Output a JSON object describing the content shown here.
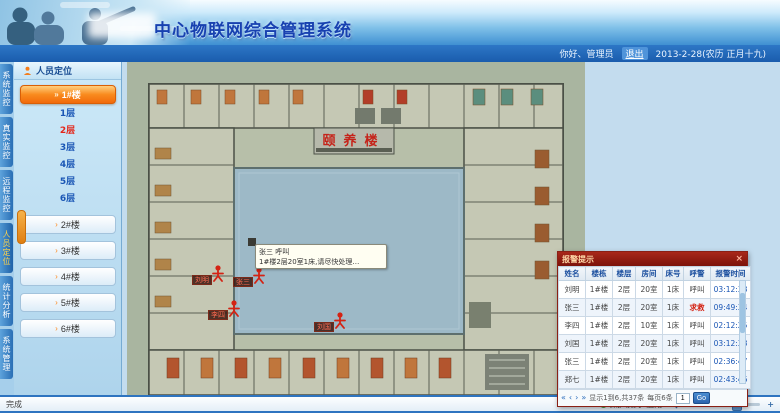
{
  "header": {
    "title": "中心物联网综合管理系统"
  },
  "userbar": {
    "greeting": "你好、管理员",
    "logout": "退出",
    "date": "2013-2-28(农历 正月十九)"
  },
  "nav_tabs": [
    {
      "label": "系统监控",
      "active": false
    },
    {
      "label": "真实监控",
      "active": false
    },
    {
      "label": "远程监控",
      "active": false
    },
    {
      "label": "人员定位",
      "active": true
    },
    {
      "label": "统计分析",
      "active": false
    },
    {
      "label": "系统管理",
      "active": false
    }
  ],
  "sidebar": {
    "header": "人员定位",
    "active_building": "1#楼",
    "floors": [
      {
        "label": "1层",
        "active": false
      },
      {
        "label": "2层",
        "active": true
      },
      {
        "label": "3层",
        "active": false
      },
      {
        "label": "4层",
        "active": false
      },
      {
        "label": "5层",
        "active": false
      },
      {
        "label": "6层",
        "active": false
      }
    ],
    "buildings": [
      "2#楼",
      "3#楼",
      "4#楼",
      "5#楼",
      "6#楼"
    ]
  },
  "plan": {
    "plaque": "颐养楼",
    "tooltip": {
      "line1": "张三 呼叫",
      "line2": "1#楼2层20室1床,请尽快处理…"
    },
    "markers": [
      {
        "name": "刘明"
      },
      {
        "name": "张三"
      },
      {
        "name": "李四"
      },
      {
        "name": "刘国"
      }
    ]
  },
  "popup": {
    "title": "报警提示",
    "close": "×",
    "columns": [
      "姓名",
      "楼栋",
      "楼层",
      "房间",
      "床号",
      "呼警",
      "报警时间"
    ],
    "rows": [
      [
        "刘明",
        "1#楼",
        "2层",
        "20室",
        "1床",
        "呼叫",
        "03:12:38"
      ],
      [
        "张三",
        "1#楼",
        "2层",
        "20室",
        "1床",
        "求救",
        "09:49:34"
      ],
      [
        "李四",
        "1#楼",
        "2层",
        "10室",
        "1床",
        "呼叫",
        "02:12:25"
      ],
      [
        "刘国",
        "1#楼",
        "2层",
        "20室",
        "1床",
        "呼叫",
        "03:12:38"
      ],
      [
        "张三",
        "1#楼",
        "2层",
        "20室",
        "1床",
        "呼叫",
        "02:36:47"
      ],
      [
        "郑七",
        "1#楼",
        "2层",
        "20室",
        "1床",
        "呼叫",
        "02:43:46"
      ]
    ],
    "pagination": {
      "info": "显示1到6,共37条",
      "per_page": "每页6条",
      "goto_value": "1",
      "go_label": "Go"
    }
  },
  "statusbar": {
    "left": "完成",
    "mode": "保护模式: 启用",
    "zoom": "100%"
  },
  "colors": {
    "accent_orange": "#f47c1a",
    "alert_red": "#cc2211",
    "popup_title_red": "#8d1a0e",
    "link_blue": "#1a56b5",
    "courtyard_blue": "#9db9c7",
    "plan_sage": "#a9b5a0"
  }
}
